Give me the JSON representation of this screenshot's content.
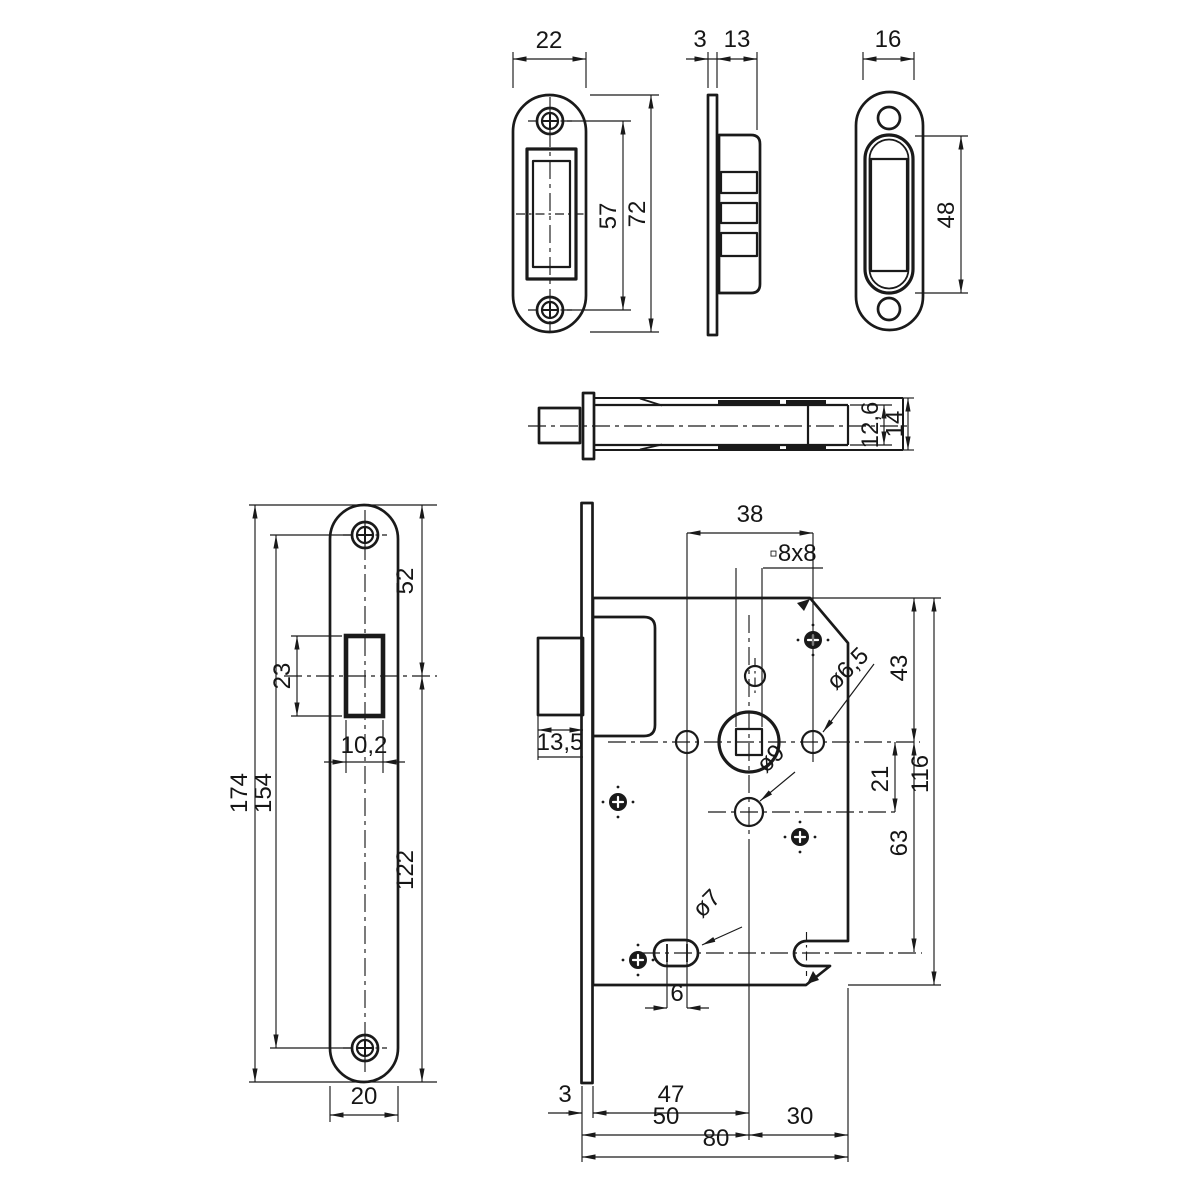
{
  "drawing": {
    "background": "#ffffff",
    "ink": "#1a1a1a",
    "views": {
      "strike_plate_front": {
        "dims": {
          "width": "22",
          "screw_spacing": "57",
          "height": "72"
        }
      },
      "strike_plate_side": {
        "dims": {
          "plate_thickness": "3",
          "body_depth": "13"
        }
      },
      "magnet_catch_front": {
        "dims": {
          "body_width": "16",
          "slot_height": "48"
        }
      },
      "bolt_side": {
        "dims": {
          "bolt_height": "12,6",
          "total_height": "14"
        }
      },
      "strike_plate_long": {
        "dims": {
          "top_to_slot_center": "52",
          "slot_height": "23",
          "slot_width": "10,2",
          "total_height": "174",
          "screw_spacing": "154",
          "slot_center_to_bottom": "122",
          "width": "20"
        }
      },
      "lock_case": {
        "dims": {
          "hole_spacing": "38",
          "spindle_square": "▫8x8",
          "bolt_protrusion": "13,5",
          "follower_dia": "ø6,5",
          "top_to_spindle": "43",
          "spindle_to_hole": "21",
          "hole_dia": "ø9",
          "case_height": "116",
          "spindle_to_slot": "63",
          "slot_dia": "ø7",
          "slot_length": "6",
          "faceplate_thickness": "3",
          "front_to_spindle": "47",
          "backset": "50",
          "spindle_to_rear": "30",
          "case_depth": "80"
        }
      }
    }
  }
}
